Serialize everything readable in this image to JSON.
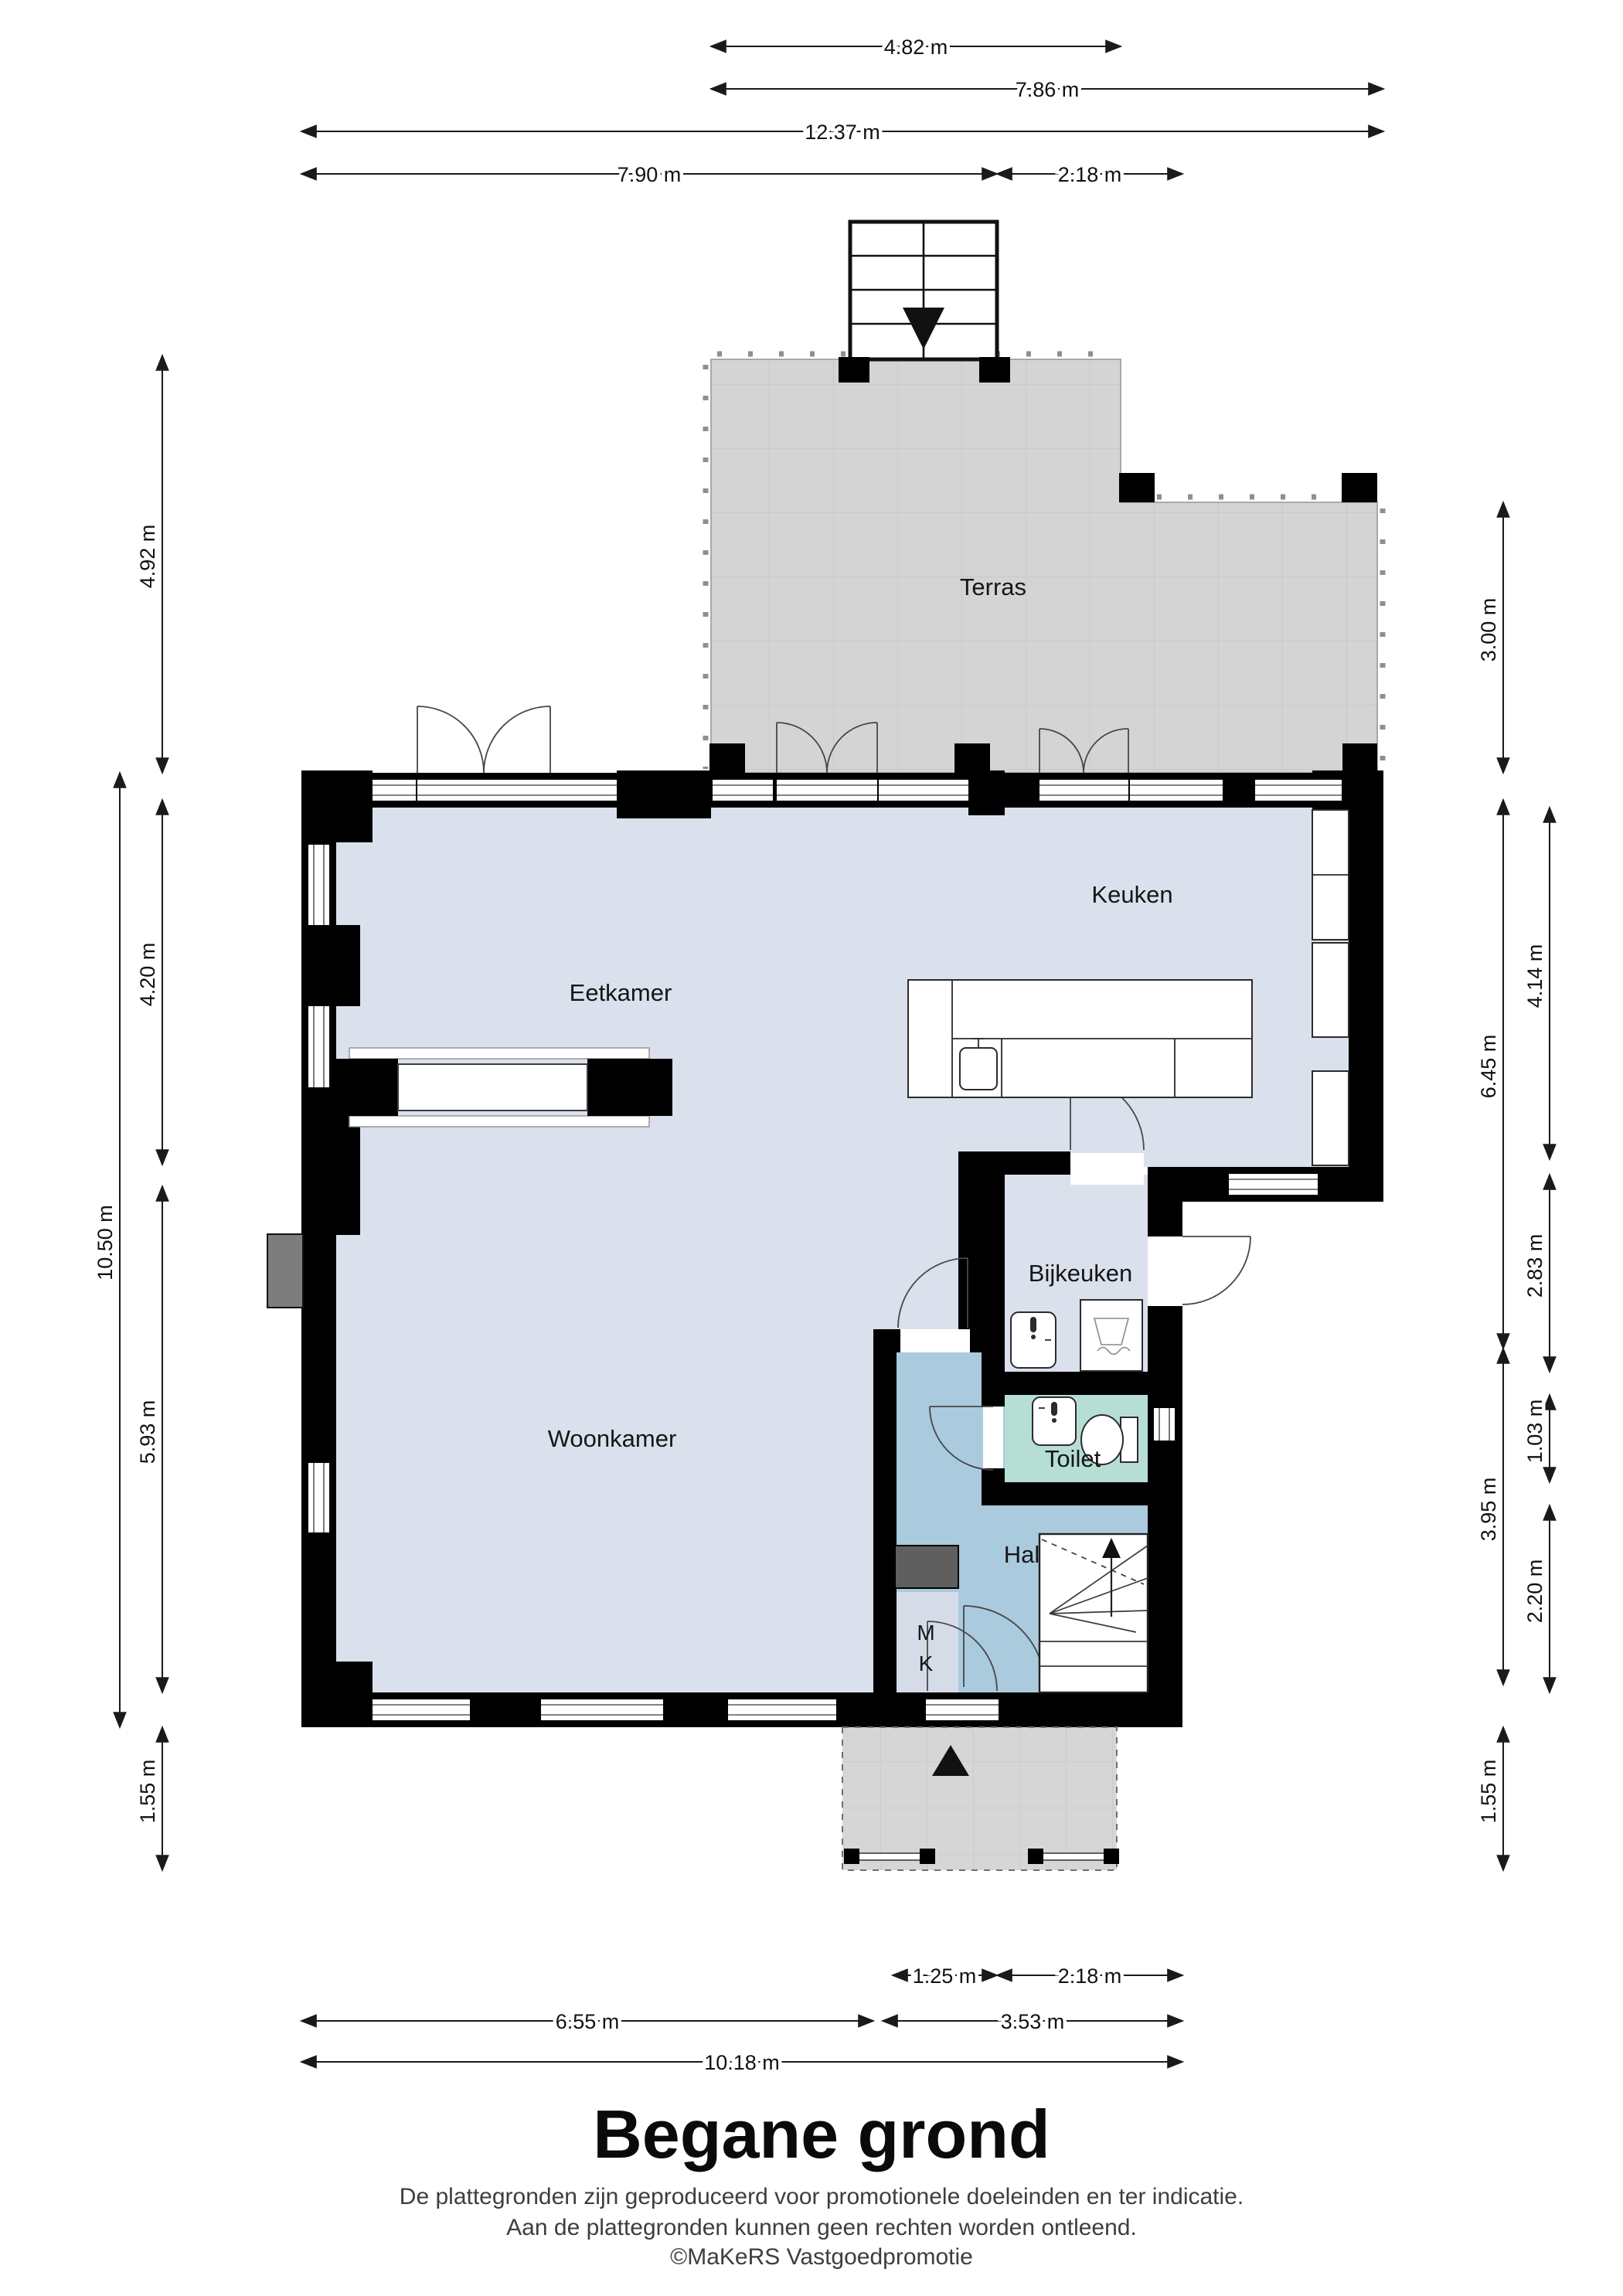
{
  "title": "Begane grond",
  "footer": {
    "line1": "De plattegronden zijn geproduceerd voor promotionele doeleinden en ter indicatie.",
    "line2": "Aan de plattegronden kunnen geen rechten worden ontleend.",
    "credit": "©MaKeRS Vastgoedpromotie"
  },
  "rooms": [
    {
      "id": "terras",
      "label": "Terras"
    },
    {
      "id": "keuken",
      "label": "Keuken"
    },
    {
      "id": "eetkamer",
      "label": "Eetkamer"
    },
    {
      "id": "bijkeuken",
      "label": "Bijkeuken"
    },
    {
      "id": "woonkamer",
      "label": "Woonkamer"
    },
    {
      "id": "toilet",
      "label": "Toilet"
    },
    {
      "id": "hal",
      "label": "Hal"
    },
    {
      "id": "meterkast-m",
      "label": "M"
    },
    {
      "id": "meterkast-k",
      "label": "K"
    }
  ],
  "dimensions": {
    "top": [
      {
        "label": "4.82 m"
      },
      {
        "label": "7.86 m"
      },
      {
        "label": "12.37 m"
      },
      {
        "label": "7.90 m"
      },
      {
        "label": "2.18 m"
      }
    ],
    "left": [
      {
        "label": "4.92 m"
      },
      {
        "label": "10.50 m"
      },
      {
        "label": "4.20 m"
      },
      {
        "label": "5.93 m"
      },
      {
        "label": "1.55 m"
      }
    ],
    "right": [
      {
        "label": "3.00 m"
      },
      {
        "label": "6.45 m"
      },
      {
        "label": "3.95 m"
      },
      {
        "label": "1.55 m"
      },
      {
        "label": "4.14 m"
      },
      {
        "label": "2.83 m"
      },
      {
        "label": "1.03 m"
      },
      {
        "label": "2.20 m"
      }
    ],
    "bottom": [
      {
        "label": "1.25 m"
      },
      {
        "label": "2.18 m"
      },
      {
        "label": "6.55 m"
      },
      {
        "label": "3.53 m"
      },
      {
        "label": "10.18 m"
      }
    ]
  },
  "colors": {
    "floor_main": "#dae1ed",
    "floor_hal": "#aacade",
    "floor_toilet": "#b6ded5",
    "floor_mk": "#d5dce8",
    "terras": "#d4d4d4",
    "porch": "#d6d6d6",
    "wall": "#000000",
    "duct": "#5f5f5f",
    "chimney": "#7d7d7d"
  }
}
